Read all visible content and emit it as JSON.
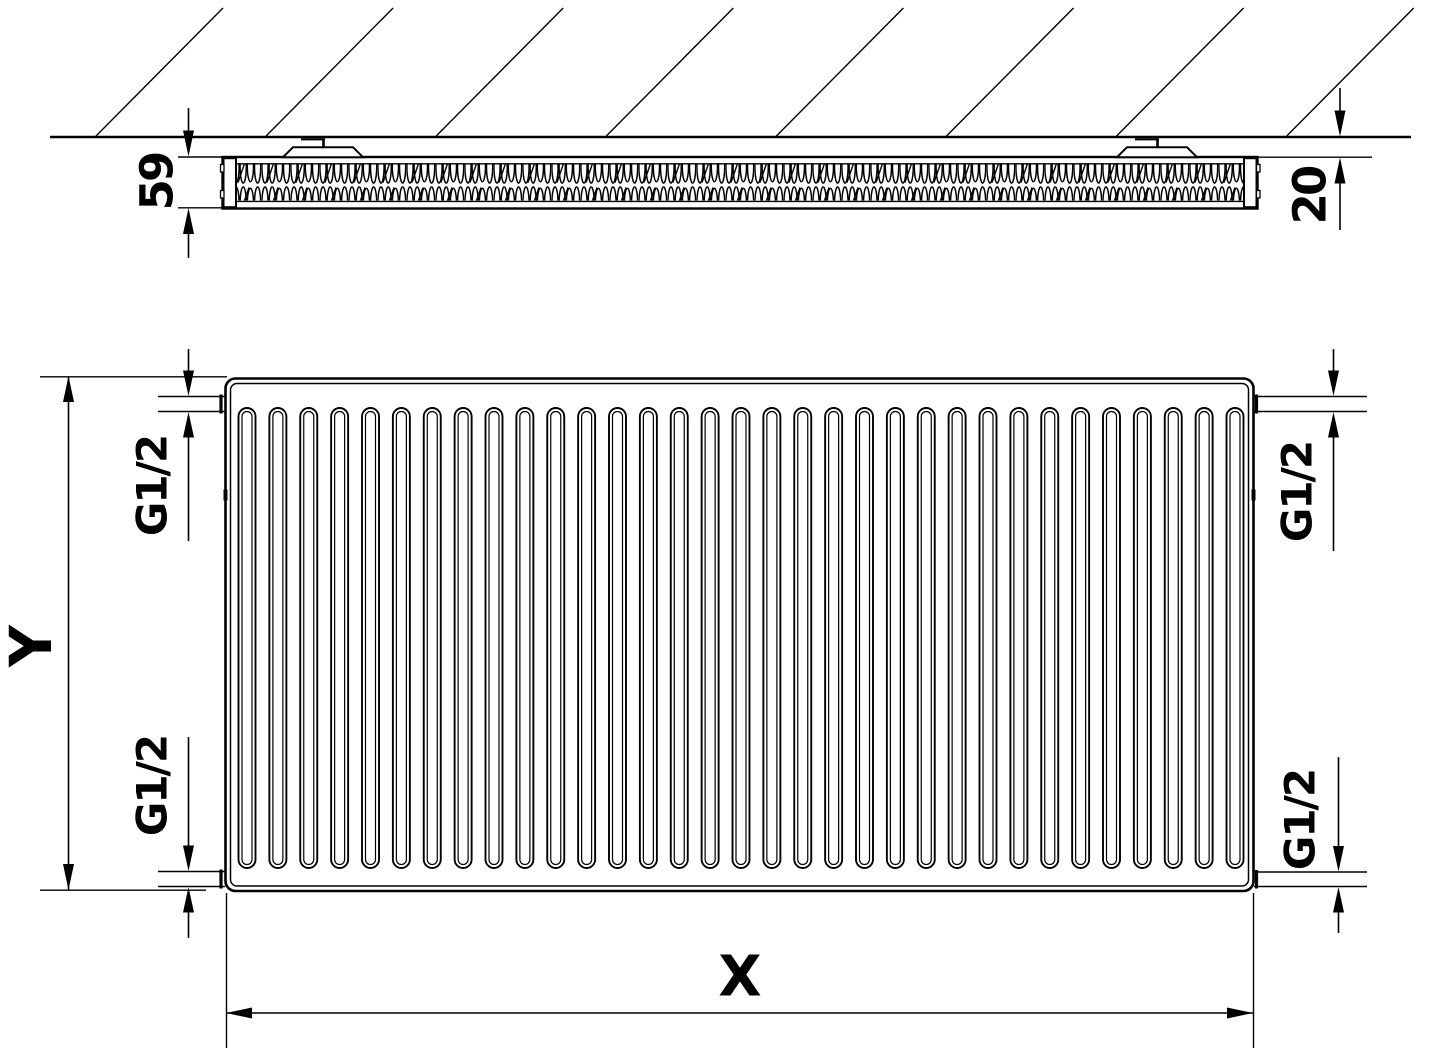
{
  "colors": {
    "line": "#000000",
    "background": "#ffffff"
  },
  "labels": {
    "depth": "59",
    "wall_gap": "20",
    "height": "Y",
    "width": "X",
    "connection_top_left": "G1/2",
    "connection_bottom_left": "G1/2",
    "connection_top_right": "G1/2",
    "connection_bottom_right": "G1/2"
  },
  "top_view": {
    "hatch_count": 8,
    "bracket_count": 2
  },
  "front_view": {
    "groove_count": 33
  }
}
